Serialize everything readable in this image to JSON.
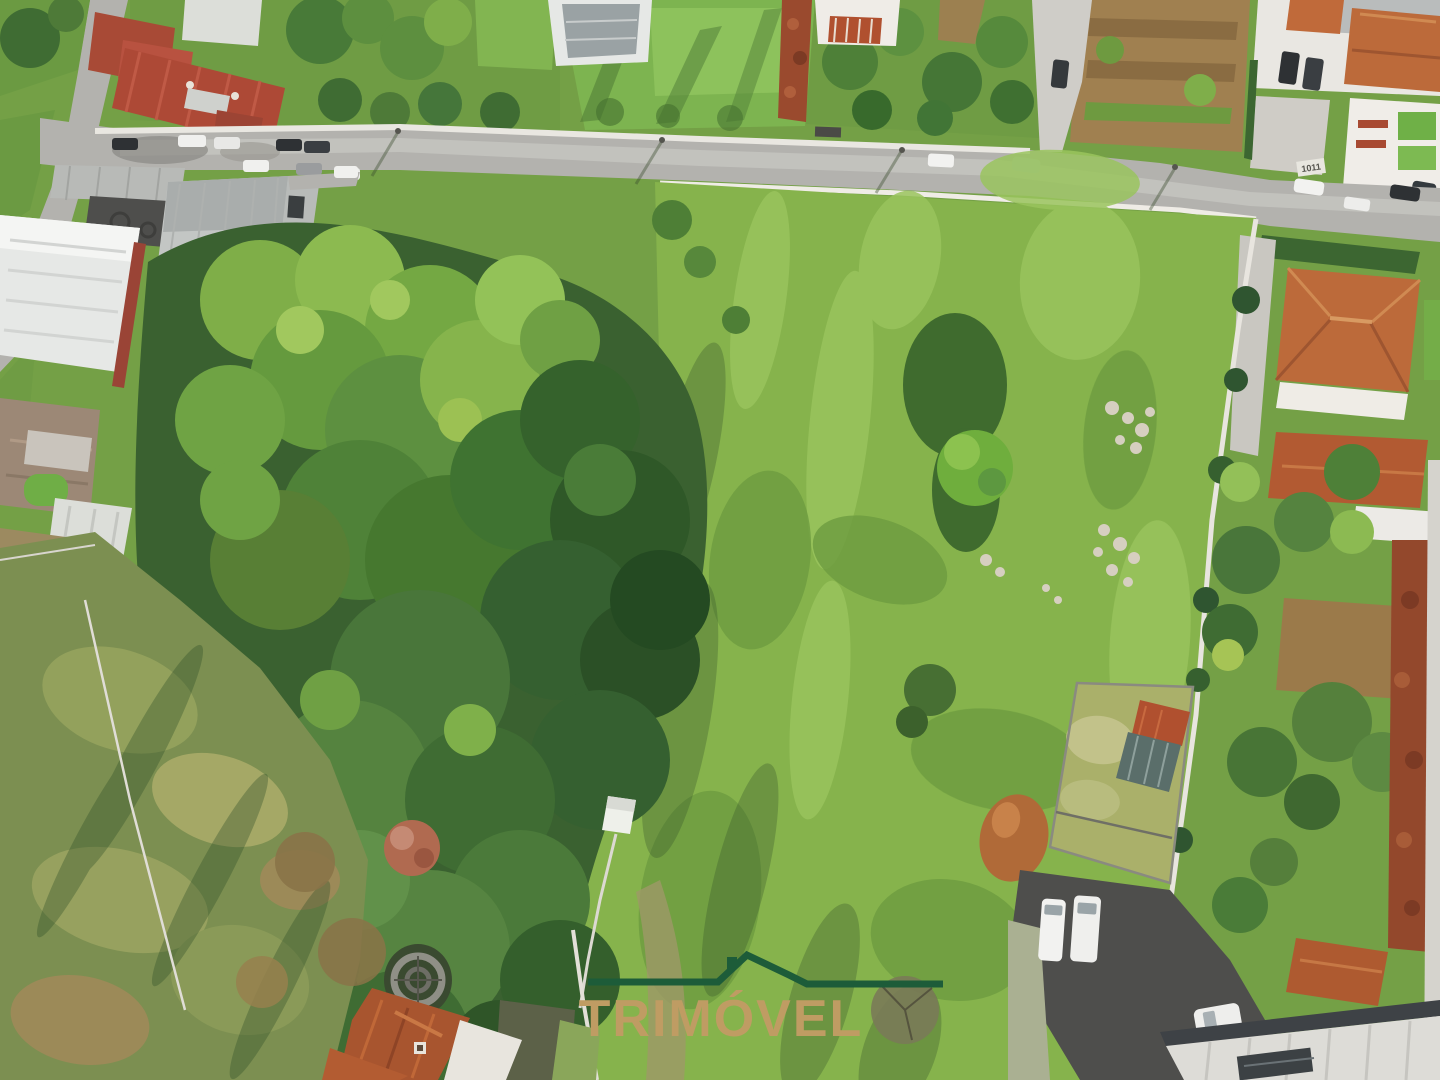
{
  "image": {
    "kind": "aerial-drone-photo",
    "subject": "vacant-land-plot-with-surrounding-houses"
  },
  "watermark": {
    "text": "TRIMÓVEL",
    "text_color": "#BF9C63",
    "roof_color": "#1D5C39"
  },
  "road_sign": {
    "text": "1011"
  },
  "palette": {
    "base": "#74A046",
    "meadow": "#86B34C",
    "meadow_light": "#9AC45E",
    "road": "#B3B2AE",
    "tree_dark": "#3A6130",
    "tree_mid": "#588C3A",
    "tree_bright": "#8CBA50",
    "scrub_olive": "#7C8F51",
    "roof_orange": "#BC6A3A",
    "roof_red": "#AD4936",
    "building_white": "#E6E8E6",
    "wall_white": "#E8E6E0",
    "asphalt_dark": "#4E4E4C",
    "hedge_rust": "#9A4A2E"
  }
}
